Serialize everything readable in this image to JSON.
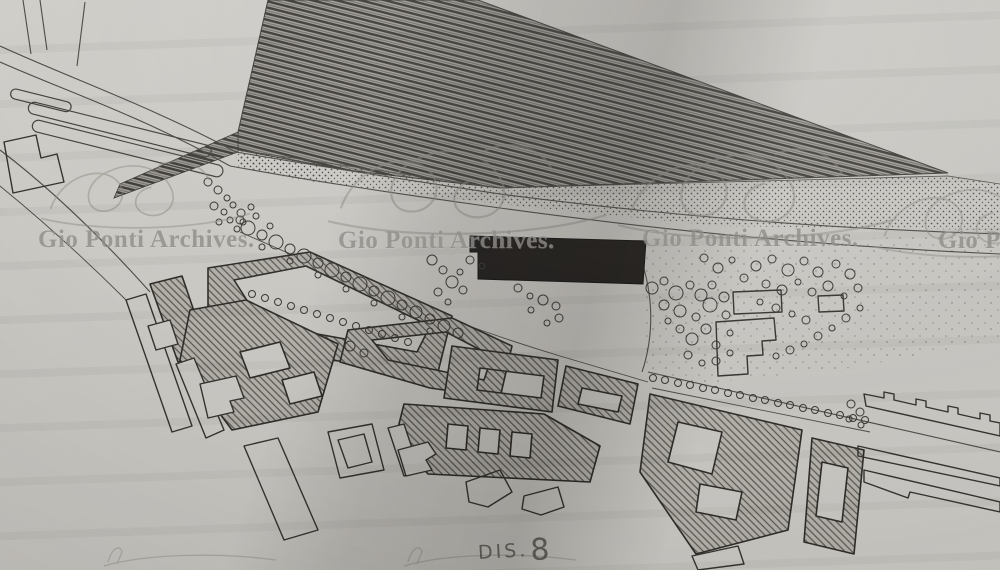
{
  "watermark": {
    "text": "Gio Ponti Archives."
  },
  "annotation": {
    "prefix": "DIS.",
    "number": "8"
  },
  "colors": {
    "paper": "#c9c7c2",
    "ink": "#32302c",
    "road_ink": "#4e4c47",
    "hatch_line": "#57554f",
    "track_line": "#3f3d39",
    "dark_building": "#221f1c",
    "watermark_gray": "#908d86"
  }
}
